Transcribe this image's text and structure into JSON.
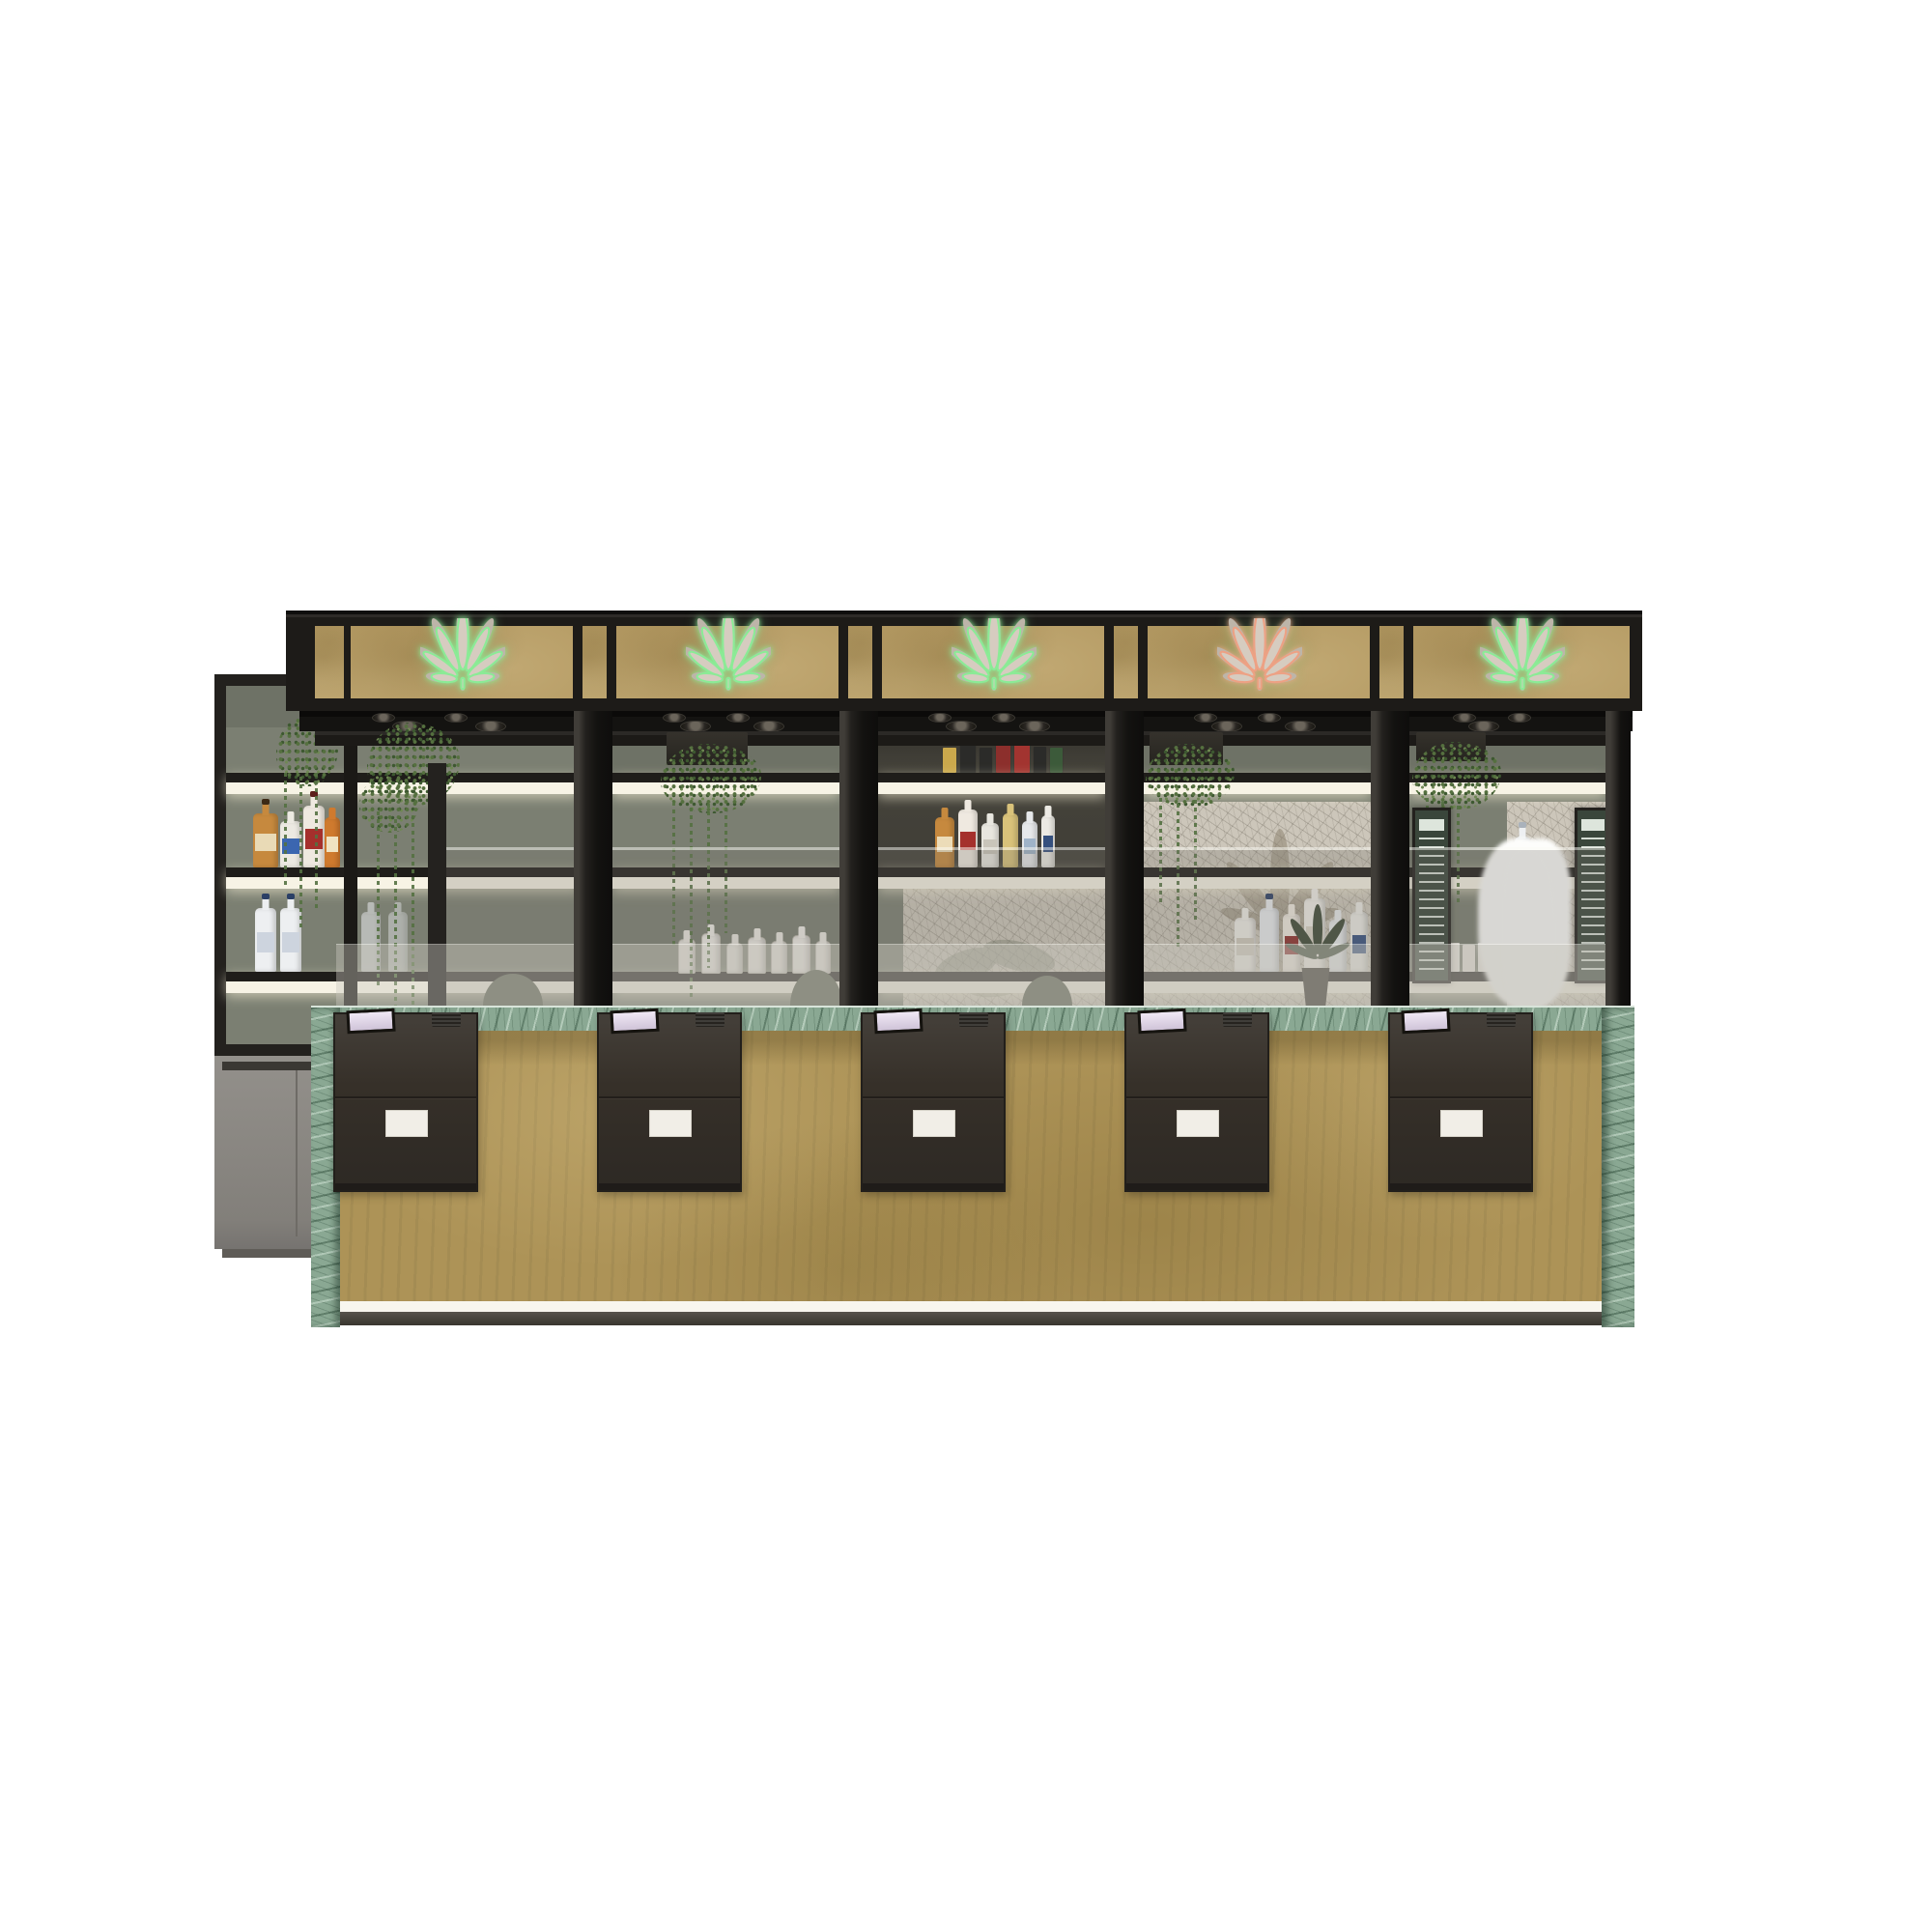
{
  "scene": {
    "type": "3d-interior-render",
    "subject": "Cannabis dispensary bar counter - front elevation",
    "background": "#ffffff",
    "service_bays": 5,
    "register_count": 5,
    "leaf_signs": [
      "green",
      "green",
      "green",
      "pink",
      "green"
    ],
    "shelf_led_strips": 3,
    "props": {
      "hanging_vine_plants": 5,
      "liquor_bottle_groups": 5,
      "menu_boards": 2,
      "potted_plant": 1,
      "bar_stools": 3
    }
  },
  "theme": {
    "neon-green": "#8beb96",
    "neon-pink": "#eda184",
    "sign-fill": "#d6ccc0",
    "sign-halo": "#bdb5a9",
    "frame-black": "#1d1b18",
    "soffit-black": "#141311",
    "panel-tan": "#b49a63",
    "counter-tan": "#ad9357",
    "marble-green": "#8aa893",
    "wall-sage": "#7b7f72",
    "wall-sage-dark": "#6e7266",
    "led-white": "#f7f3e5",
    "register-charcoal": "#38332e",
    "screen-lilac": "#e9dff0",
    "plate-white": "#f1eee7",
    "cabinet-gray": "#8b8883",
    "mosaic-gray": "#ccc6ba",
    "plant-green": "#55703f",
    "glass-tint": "rgba(122,119,110,0.28)",
    "glass-light": "rgba(203,200,190,0.42)"
  }
}
